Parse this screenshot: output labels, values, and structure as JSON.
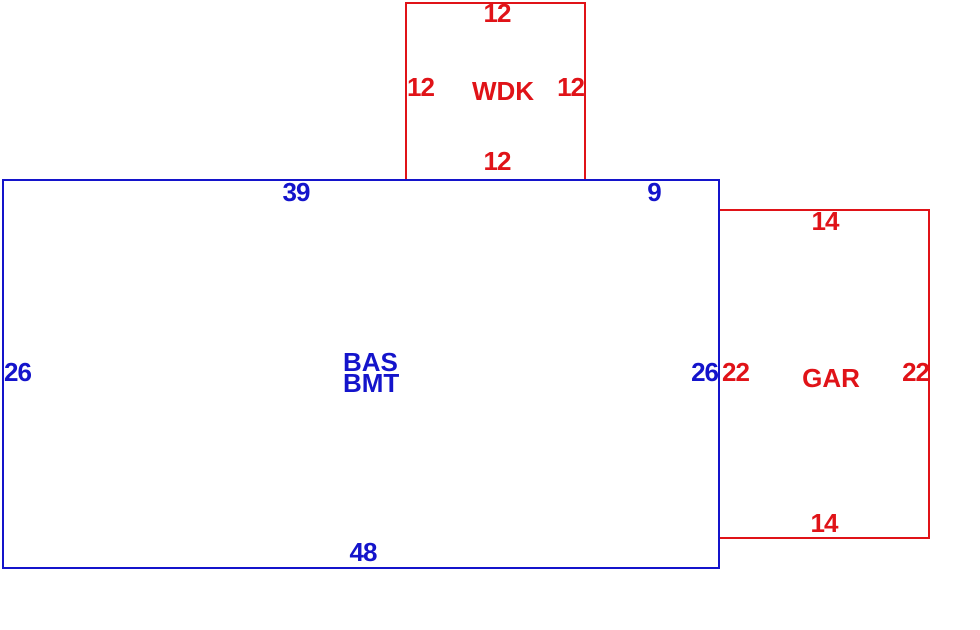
{
  "sketch": {
    "colors": {
      "main_outline": "#1414cb",
      "attachment_outline": "#e01318"
    },
    "areas": [
      {
        "id": "wdk",
        "label": "WDK",
        "dims": {
          "top": "12",
          "left": "12",
          "right": "12",
          "bottom": "12"
        }
      },
      {
        "id": "bas",
        "label": "BAS\nBMT",
        "dims": {
          "top_left": "39",
          "top_right": "9",
          "left": "26",
          "right": "26",
          "bottom": "48"
        }
      },
      {
        "id": "gar",
        "label": "GAR",
        "dims": {
          "top": "14",
          "left": "22",
          "right": "22",
          "bottom": "14"
        }
      }
    ]
  }
}
